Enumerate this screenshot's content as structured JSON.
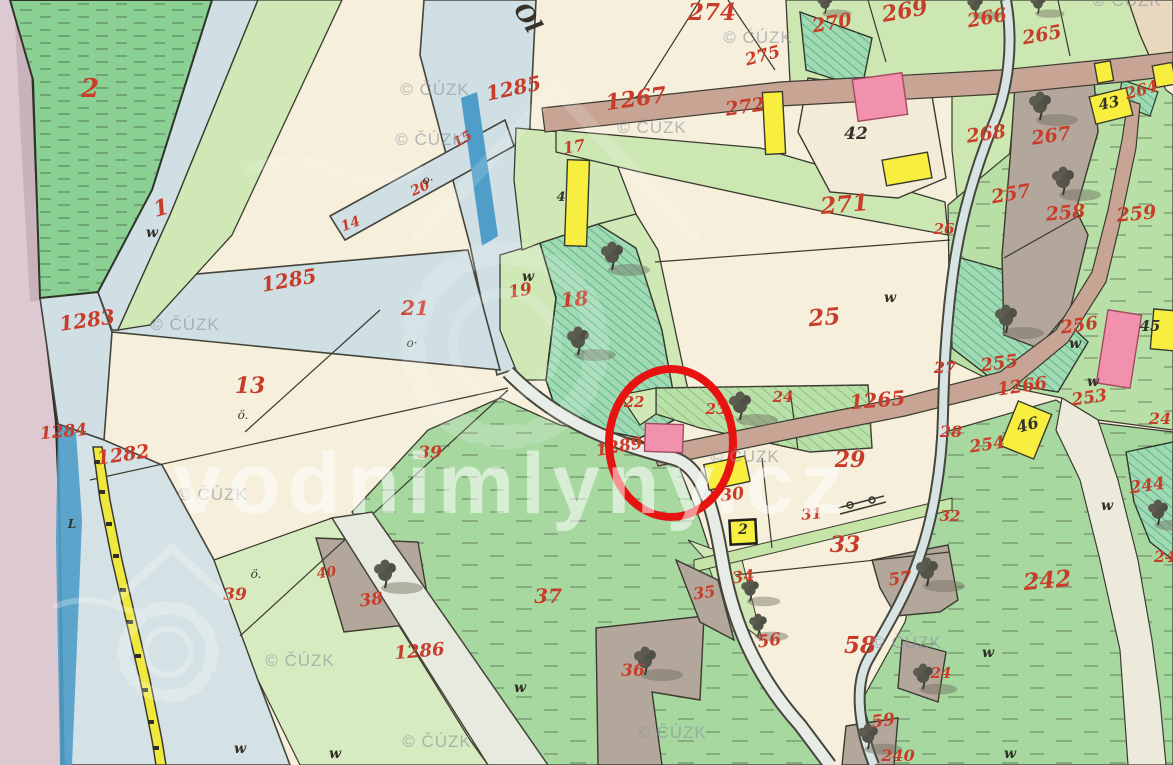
{
  "map": {
    "source_watermark": {
      "text": "© ČÚZK",
      "positions": [
        [
          435,
          95
        ],
        [
          430,
          145
        ],
        [
          652,
          133
        ],
        [
          758,
          43
        ],
        [
          1127,
          6
        ],
        [
          185,
          330
        ],
        [
          213,
          500
        ],
        [
          745,
          462
        ],
        [
          907,
          648
        ],
        [
          300,
          666
        ],
        [
          437,
          747
        ],
        [
          672,
          738
        ]
      ]
    },
    "site_watermark": {
      "text": "vodnimlyny.cz",
      "x": 512,
      "y": 513,
      "size": 86
    },
    "annotation": {
      "type": "highlight-circle",
      "cx": 671,
      "cy": 443,
      "rx": 62,
      "ry": 74,
      "color": "#e61310"
    },
    "stream_name": {
      "t": "Ol",
      "x": 521,
      "y": 22,
      "s": 24,
      "r": 58
    },
    "parcel_labels": [
      {
        "t": "2",
        "x": 90,
        "y": 97,
        "s": 26
      },
      {
        "t": "1",
        "x": 163,
        "y": 215,
        "s": 22,
        "r": -15
      },
      {
        "t": "1283",
        "x": 88,
        "y": 327,
        "s": 20,
        "r": -8
      },
      {
        "t": "1284",
        "x": 64,
        "y": 437,
        "s": 17,
        "r": -5
      },
      {
        "t": "1282",
        "x": 124,
        "y": 461,
        "s": 19,
        "r": -8
      },
      {
        "t": "1285",
        "x": 290,
        "y": 287,
        "s": 20,
        "r": -10
      },
      {
        "t": "1285",
        "x": 515,
        "y": 95,
        "s": 20,
        "r": -12
      },
      {
        "t": "13",
        "x": 250,
        "y": 393,
        "s": 22
      },
      {
        "t": "21",
        "x": 415,
        "y": 315,
        "s": 20
      },
      {
        "t": "39",
        "x": 430,
        "y": 458,
        "s": 17
      },
      {
        "t": "39",
        "x": 235,
        "y": 600,
        "s": 17
      },
      {
        "t": "14",
        "x": 352,
        "y": 228,
        "s": 14,
        "r": -20
      },
      {
        "t": "20",
        "x": 422,
        "y": 192,
        "s": 14,
        "r": -25
      },
      {
        "t": "15",
        "x": 465,
        "y": 143,
        "s": 14,
        "r": -30
      },
      {
        "t": "1267",
        "x": 637,
        "y": 106,
        "s": 22,
        "r": -8
      },
      {
        "t": "274",
        "x": 712,
        "y": 20,
        "s": 23
      },
      {
        "t": "275",
        "x": 764,
        "y": 61,
        "s": 17,
        "r": -15
      },
      {
        "t": "270",
        "x": 833,
        "y": 29,
        "s": 19,
        "r": -10
      },
      {
        "t": "269",
        "x": 906,
        "y": 18,
        "s": 22,
        "r": -10
      },
      {
        "t": "266",
        "x": 988,
        "y": 24,
        "s": 19,
        "r": -10
      },
      {
        "t": "265",
        "x": 1043,
        "y": 41,
        "s": 19,
        "r": -10
      },
      {
        "t": "272",
        "x": 746,
        "y": 113,
        "s": 19,
        "r": -8
      },
      {
        "t": "271",
        "x": 845,
        "y": 212,
        "s": 23,
        "r": -5
      },
      {
        "t": "268",
        "x": 987,
        "y": 140,
        "s": 19,
        "r": -8
      },
      {
        "t": "267",
        "x": 1052,
        "y": 142,
        "s": 19,
        "r": -8
      },
      {
        "t": "264",
        "x": 1143,
        "y": 95,
        "s": 16,
        "r": -15
      },
      {
        "t": "257",
        "x": 1012,
        "y": 200,
        "s": 19,
        "r": -10
      },
      {
        "t": "258",
        "x": 1066,
        "y": 219,
        "s": 19,
        "r": -5
      },
      {
        "t": "259",
        "x": 1137,
        "y": 220,
        "s": 19,
        "r": -5
      },
      {
        "t": "26",
        "x": 944,
        "y": 234,
        "s": 15
      },
      {
        "t": "25",
        "x": 825,
        "y": 325,
        "s": 23,
        "r": -5
      },
      {
        "t": "27",
        "x": 945,
        "y": 373,
        "s": 16
      },
      {
        "t": "28",
        "x": 951,
        "y": 437,
        "s": 16
      },
      {
        "t": "255",
        "x": 1000,
        "y": 369,
        "s": 18,
        "r": -8
      },
      {
        "t": "256",
        "x": 1080,
        "y": 331,
        "s": 18,
        "r": -8
      },
      {
        "t": "1266",
        "x": 1023,
        "y": 392,
        "s": 18,
        "r": -8
      },
      {
        "t": "1265",
        "x": 878,
        "y": 407,
        "s": 20,
        "r": -5
      },
      {
        "t": "253",
        "x": 1090,
        "y": 403,
        "s": 17,
        "r": -8
      },
      {
        "t": "254",
        "x": 988,
        "y": 450,
        "s": 17,
        "r": -8
      },
      {
        "t": "244",
        "x": 1148,
        "y": 491,
        "s": 17,
        "r": -8
      },
      {
        "t": "24",
        "x": 1160,
        "y": 424,
        "s": 16
      },
      {
        "t": "24",
        "x": 1165,
        "y": 562,
        "s": 16
      },
      {
        "t": "242",
        "x": 1048,
        "y": 588,
        "s": 23,
        "r": -5
      },
      {
        "t": "22",
        "x": 634,
        "y": 407,
        "s": 15
      },
      {
        "t": "23",
        "x": 716,
        "y": 414,
        "s": 15
      },
      {
        "t": "24",
        "x": 783,
        "y": 402,
        "s": 15
      },
      {
        "t": "1289",
        "x": 620,
        "y": 452,
        "s": 17,
        "r": -10
      },
      {
        "t": "29",
        "x": 850,
        "y": 467,
        "s": 22
      },
      {
        "t": "30",
        "x": 733,
        "y": 500,
        "s": 17,
        "r": -8
      },
      {
        "t": "31",
        "x": 812,
        "y": 519,
        "s": 15,
        "r": -5
      },
      {
        "t": "32",
        "x": 950,
        "y": 521,
        "s": 15
      },
      {
        "t": "33",
        "x": 845,
        "y": 552,
        "s": 22
      },
      {
        "t": "34",
        "x": 744,
        "y": 582,
        "s": 16,
        "r": -8
      },
      {
        "t": "35",
        "x": 705,
        "y": 598,
        "s": 16,
        "r": -8
      },
      {
        "t": "56",
        "x": 770,
        "y": 646,
        "s": 17,
        "r": -8
      },
      {
        "t": "57",
        "x": 901,
        "y": 584,
        "s": 17,
        "r": -8
      },
      {
        "t": "58",
        "x": 860,
        "y": 653,
        "s": 23
      },
      {
        "t": "59",
        "x": 884,
        "y": 726,
        "s": 17,
        "r": -8
      },
      {
        "t": "240",
        "x": 898,
        "y": 761,
        "s": 16
      },
      {
        "t": "24",
        "x": 941,
        "y": 678,
        "s": 15
      },
      {
        "t": "19",
        "x": 521,
        "y": 296,
        "s": 17,
        "r": -10
      },
      {
        "t": "18",
        "x": 575,
        "y": 306,
        "s": 20,
        "r": -5
      },
      {
        "t": "17",
        "x": 575,
        "y": 152,
        "s": 16,
        "r": -10
      },
      {
        "t": "37",
        "x": 548,
        "y": 603,
        "s": 20
      },
      {
        "t": "36",
        "x": 633,
        "y": 676,
        "s": 17
      },
      {
        "t": "38",
        "x": 372,
        "y": 605,
        "s": 17,
        "r": -8
      },
      {
        "t": "40",
        "x": 327,
        "y": 577,
        "s": 14,
        "r": -8
      },
      {
        "t": "1286",
        "x": 420,
        "y": 657,
        "s": 18,
        "r": -5
      }
    ],
    "house_labels": [
      {
        "t": "42",
        "x": 856,
        "y": 139,
        "s": 17
      },
      {
        "t": "43",
        "x": 1110,
        "y": 108,
        "s": 15,
        "r": -12
      },
      {
        "t": "45",
        "x": 1150,
        "y": 331,
        "s": 15
      },
      {
        "t": "2",
        "x": 743,
        "y": 534,
        "s": 14
      },
      {
        "t": "46",
        "x": 1029,
        "y": 430,
        "s": 16,
        "r": -15,
        "c": "#8a3a22"
      },
      {
        "t": "4",
        "x": 561,
        "y": 201,
        "s": 13
      },
      {
        "t": "L",
        "x": 72,
        "y": 528,
        "s": 12
      }
    ],
    "meadow_marks": {
      "text": "w",
      "positions": [
        [
          152,
          237
        ],
        [
          528,
          281
        ],
        [
          890,
          302
        ],
        [
          1075,
          348
        ],
        [
          1093,
          386
        ],
        [
          1107,
          510
        ],
        [
          988,
          657
        ],
        [
          520,
          692
        ],
        [
          240,
          753
        ],
        [
          335,
          758
        ],
        [
          1010,
          758
        ]
      ]
    },
    "dot_marks": [
      {
        "t": "ö.",
        "x": 243,
        "y": 419
      },
      {
        "t": "o·",
        "x": 412,
        "y": 347
      },
      {
        "t": "ö.",
        "x": 256,
        "y": 578
      },
      {
        "t": "o·",
        "x": 428,
        "y": 184
      }
    ],
    "palette": {
      "field_cream": "#f6efdc",
      "meadow_green": "#a6d8a0",
      "forest_teal": "#9fdab2",
      "water_pale": "#cfdfe4",
      "water_blue": "#4f9dc9",
      "road_brown": "#c7a493",
      "road_yellow": "#f0e83c",
      "building_pink": "#f291ad",
      "building_yellow": "#f7ee3f",
      "parcel_gray": "#b3a69a",
      "margin_lavender": "#dcc9d1",
      "label_red": "#c83d2a",
      "ink": "#3a3a2e",
      "annotation_red": "#e61310",
      "watermark_gray": "#8b949c"
    }
  }
}
